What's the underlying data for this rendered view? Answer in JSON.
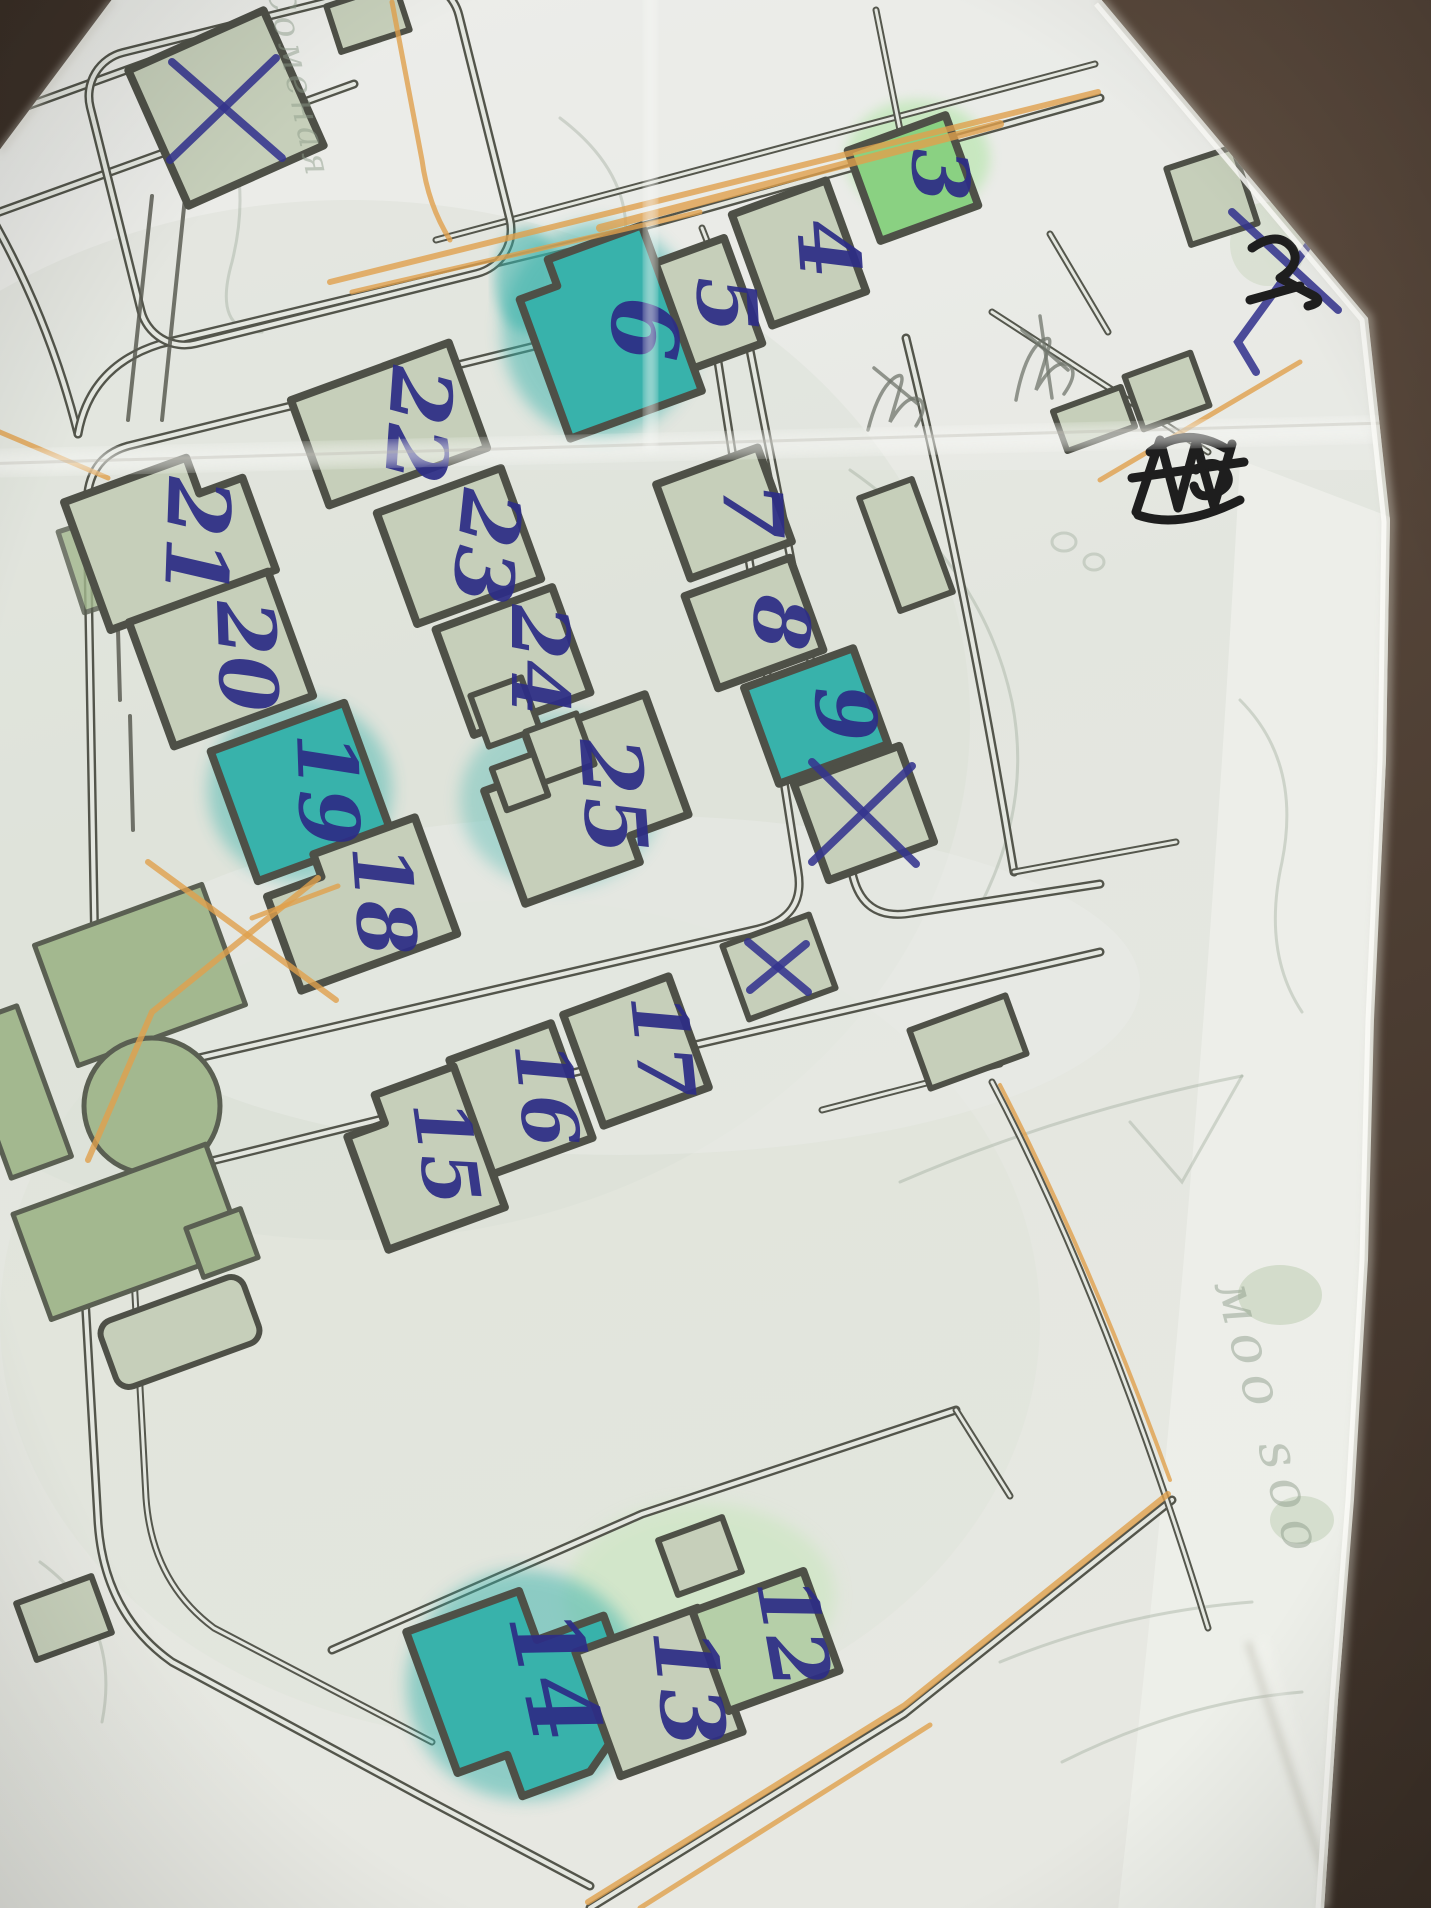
{
  "scene": {
    "description": "hand-annotated paper street map photographed on a dark desk",
    "desk_color": "#46382e",
    "paper_color": "#e8eae4"
  },
  "map": {
    "ink_color": "#32328a",
    "street_color": "#53554b",
    "orange_pencil_color": "#e0a04c",
    "teal_highlight": "#38b2ab",
    "green_highlight": "#8ad182",
    "pale_building_color": "#c6cfba",
    "park_green": "#a3b88f",
    "buildings": {
      "b3": {
        "label": "3",
        "fill": "green"
      },
      "b4": {
        "label": "4",
        "fill": "pale"
      },
      "b5": {
        "label": "5",
        "fill": "pale"
      },
      "b6": {
        "label": "6",
        "fill": "teal"
      },
      "b7": {
        "label": "7",
        "fill": "pale"
      },
      "b8": {
        "label": "8",
        "fill": "pale"
      },
      "b9": {
        "label": "9",
        "fill": "teal"
      },
      "b12": {
        "label": "12",
        "fill": "pale-green"
      },
      "b13": {
        "label": "13",
        "fill": "green"
      },
      "b14": {
        "label": "14",
        "fill": "teal"
      },
      "b15": {
        "label": "15",
        "fill": "pale"
      },
      "b16": {
        "label": "16",
        "fill": "pale"
      },
      "b17": {
        "label": "17",
        "fill": "pale"
      },
      "b18": {
        "label": "18",
        "fill": "pale"
      },
      "b19": {
        "label": "19",
        "fill": "teal"
      },
      "b20": {
        "label": "20",
        "fill": "pale"
      },
      "b21": {
        "label": "21",
        "fill": "pale"
      },
      "b22": {
        "label": "22",
        "fill": "pale-green"
      },
      "b23": {
        "label": "23",
        "fill": "pale"
      },
      "b24": {
        "label": "24",
        "fill": "pale"
      },
      "b25": {
        "label": "25",
        "fill": "teal-green"
      }
    },
    "cross_marks": [
      {
        "id": "top-left-building",
        "style": "large blue X"
      },
      {
        "id": "top-right-margin",
        "style": "blue X over black pen mark"
      },
      {
        "id": "building-below-9",
        "style": "large blue X"
      },
      {
        "id": "small-building-near-17",
        "style": "small blue x"
      }
    ],
    "scribbles": [
      {
        "id": "black-marker-scribble",
        "text": "illegible (crossed out)"
      },
      {
        "id": "pencil-note-1",
        "text": "illegible pencil"
      },
      {
        "id": "pencil-note-2",
        "text": "illegible pencil"
      }
    ],
    "faint_labels": [
      {
        "id": "street-name-top-left",
        "text": "Соменая"
      },
      {
        "id": "street-name-bottom-right",
        "text": "моо ѕоо"
      }
    ]
  }
}
